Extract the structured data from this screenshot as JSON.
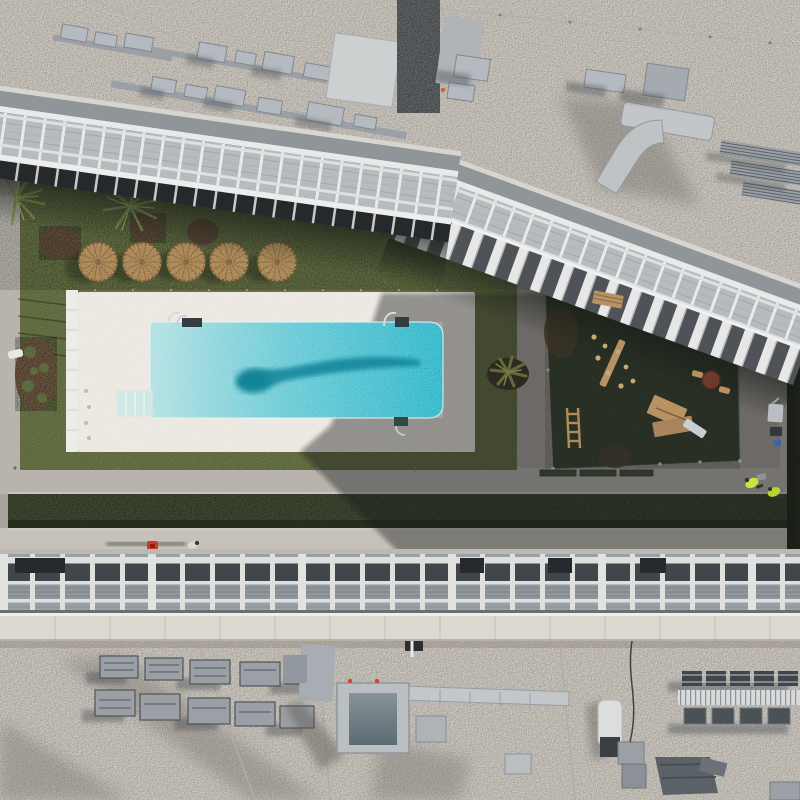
{
  "meta": {
    "type": "aerial-drone-photograph",
    "description": "Straight-down drone view of a residential courtyard between two apartment buildings: turquoise swimming pool on white deck, row of five straw umbrellas, palm trees, dark playground lawn with wooden play equipment, clipped hedge rows, paved walkways, and gravel rooftops with HVAC ducting at top and bottom.",
    "lighting": "hard sun from upper right, long shadows to lower left"
  },
  "palette": {
    "gravel": "#d9d4cb",
    "gravel_dark": "#c4bdb2",
    "path": "#a8a49e",
    "path_sunlit": "#b8b4ad",
    "walkway_bright": "#c6c2ba",
    "deck": "#e9e5dd",
    "pool_shallow": "#a9dde0",
    "pool_deep": "#17b0c5",
    "pool_streak": "#0e7f95",
    "steps": "#cfe9e6",
    "lawn": "#6e7a4a",
    "lawn_dark": "#3c4a33",
    "hedge": "#47543a",
    "hedge_dark": "#222b1c",
    "canopy_white": "#e8e9e8",
    "canopy_fascia": "#90959a",
    "canopy_panel": "#b6bbbf",
    "terrace_dark": "#26292c",
    "grid_dark": "#41464b",
    "grid_cell": "#8f969c",
    "parapet": "#ddd9d1",
    "hvac": "#a7adb2",
    "hvac_light": "#c2c6c9",
    "hvac_dark": "#3e454b",
    "umbrella": "#c8a069",
    "umbrella_dark": "#8a6a42",
    "mulch": "#7a6148",
    "wood": "#b99263",
    "slide_metal": "#c9ced2",
    "spring_toy": "#6e3a2c",
    "palm_leaf": "#90a057",
    "agave": "#b7bf6e",
    "red_item": "#cf3a28",
    "hivis": "#cde23c",
    "big_shadow": "rgba(18,22,28,0.42)"
  },
  "inventory": {
    "umbrellas": {
      "count": 5,
      "material": "straw",
      "location": "lawn above pool deck"
    },
    "palm_trees": {
      "count": 2,
      "location": "upper-left lawn"
    },
    "agave_plants": {
      "count": 2,
      "location": "left planter and between lawns"
    },
    "pool": {
      "shape": "long rectangle, rounded deep end at right",
      "features": [
        "3 handrails",
        "corner entry steps",
        "tree shadow streak across water"
      ]
    },
    "playground": {
      "equipment": [
        "wooden bench",
        "balance beam with stepping pods",
        "spring disc toy",
        "wooden playhouse with metal slide",
        "ladder frame"
      ]
    },
    "people": {
      "pedestrian_on_walkway": 1,
      "workers_in_hivis": 2
    },
    "misc": [
      "red bag on walkway",
      "green glass balustrade panels",
      "hedge rows",
      "rooftop HVAC duct clusters",
      "skylight box",
      "equipment racks"
    ]
  }
}
